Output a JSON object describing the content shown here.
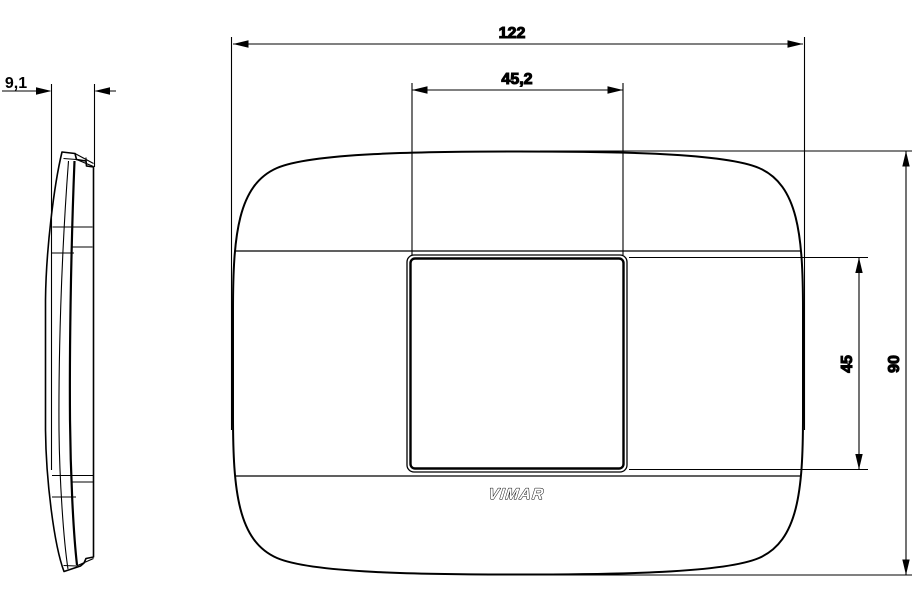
{
  "drawing": {
    "brand_logo": "VIMAR",
    "background_color": "#ffffff",
    "line_color": "#000000",
    "side_view": {
      "thickness_label": "9,1"
    },
    "front_view": {
      "overall_width_label": "122",
      "opening_width_label": "45,2",
      "opening_height_label": "45",
      "overall_height_label": "90"
    }
  }
}
